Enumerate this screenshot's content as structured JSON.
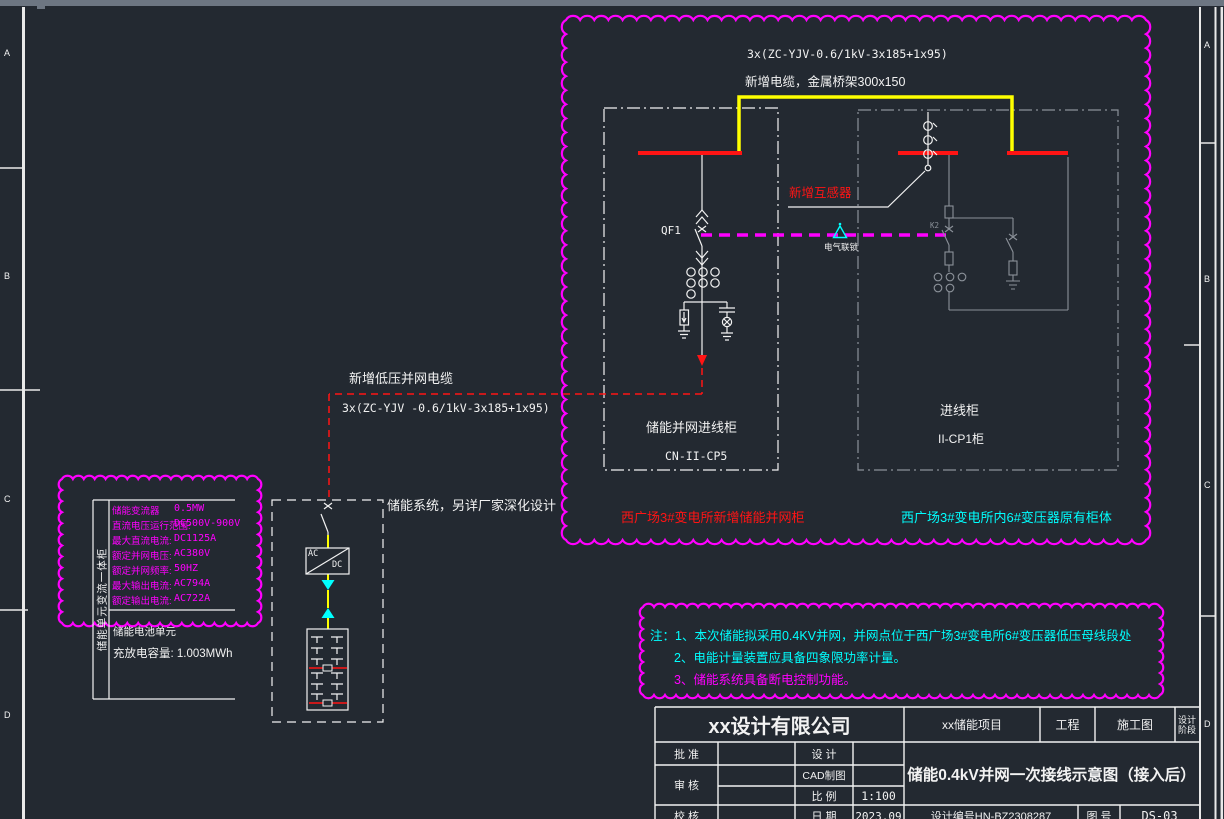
{
  "colors": {
    "background": "#232931",
    "line_white": "#f2f2f2",
    "line_grey": "#8b9199",
    "red": "#ff1414",
    "yellow": "#ffff00",
    "magenta": "#ff00ff",
    "cyan": "#00ffff"
  },
  "zones": {
    "left": [
      "A",
      "B",
      "C",
      "D"
    ],
    "right": [
      "A",
      "B",
      "C",
      "D"
    ]
  },
  "top_cable": {
    "spec": "3x(ZC-YJV-0.6/1kV-3x185+1x95)",
    "note": "新增电缆，金属桥架300x150"
  },
  "new_ct_label": "新增互感器",
  "interlock_label": "电气联锁",
  "breaker_left_tag": "QF1",
  "breaker_right_tag": "K2",
  "left_cabinet": {
    "name": "储能并网进线柜",
    "code": "CN-II-CP5",
    "caption": "西广场3#变电所新增储能并网柜"
  },
  "right_cabinet": {
    "name": "进线柜",
    "code": "II-CP1柜",
    "caption": "西广场3#变电所内6#变压器原有柜体"
  },
  "lv_cable": {
    "note": "新增低压并网电缆",
    "spec": "3x(ZC-YJV -0.6/1kV-3x185+1x95)"
  },
  "pcs": {
    "side_label": "储能单元变流一体柜",
    "params": [
      {
        "label": "储能变流器",
        "value": "0.5MW"
      },
      {
        "label": "直流电压运行范围:",
        "value": "DC500V-900V"
      },
      {
        "label": "最大直流电流:",
        "value": "DC1125A"
      },
      {
        "label": "额定并网电压:",
        "value": "AC380V"
      },
      {
        "label": "额定并网频率:",
        "value": "50HZ"
      },
      {
        "label": "最大输出电流:",
        "value": "AC794A"
      },
      {
        "label": "额定输出电流:",
        "value": "AC722A"
      }
    ],
    "battery_section": {
      "title": "储能电池单元",
      "capacity": "充放电容量: 1.003MWh"
    }
  },
  "storage_system": {
    "note": "储能系统，另详厂家深化设计",
    "converter": {
      "ac": "AC",
      "dc": "DC"
    }
  },
  "notes": {
    "line1": "注：1、本次储能拟采用0.4KV并网，并网点位于西广场3#变电所6#变压器低压母线段处",
    "line2": "2、电能计量装置应具备四象限功率计量。",
    "line3": "3、储能系统具备断电控制功能。"
  },
  "title_block": {
    "company": "xx设计有限公司",
    "project": "xx储能项目",
    "project_label": "工程",
    "stage": "施工图",
    "stage_label_line1": "设计",
    "stage_label_line2": "阶段",
    "approve_label": "批 准",
    "design_label": "设 计",
    "review_label": "审 核",
    "cad_label": "CAD制图",
    "scale_label": "比 例",
    "scale": "1:100",
    "check_label": "校 核",
    "date_label": "日 期",
    "date": "2023.09",
    "drawing_title": "储能0.4kV并网一次接线示意图（接入后）",
    "design_no": "设计编号HN-BZ2308287",
    "fig_label": "图 号",
    "fig_no": "DS-03"
  }
}
